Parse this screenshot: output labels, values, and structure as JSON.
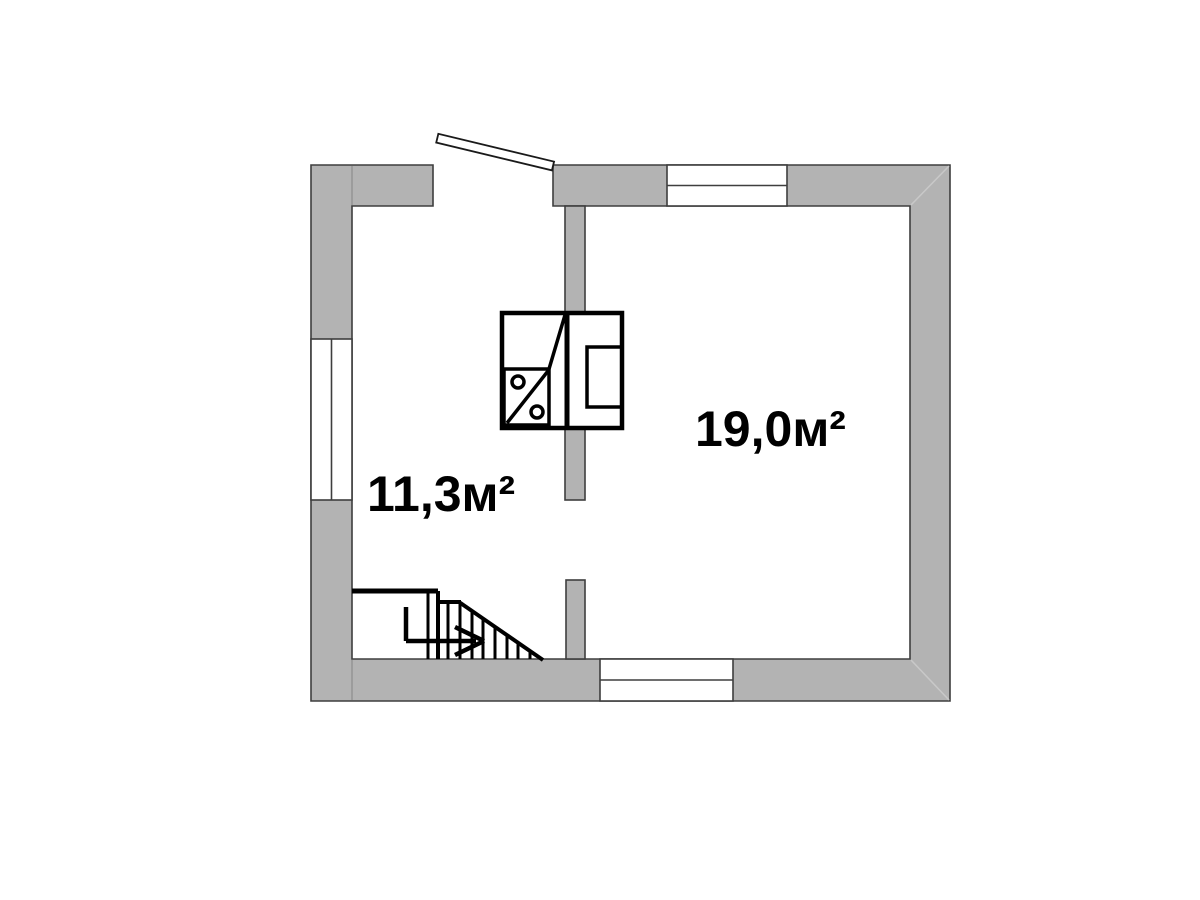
{
  "rooms": [
    {
      "id": "left-room",
      "area_label": "11,3м²"
    },
    {
      "id": "right-room",
      "area_label": "19,0м²"
    }
  ],
  "colors": {
    "background": "#ffffff",
    "wall_fill": "#b3b3b3",
    "wall_outline": "#3e3e3e",
    "black_line": "#000000",
    "miter_line": "#c8c8c8",
    "joint_line": "#8f8f8f",
    "label_color": "#000000"
  },
  "symbols": {
    "door": "open-door-leaf",
    "windows": [
      "left-wall-window",
      "top-wall-window",
      "bottom-wall-window"
    ],
    "staircase": "staircase-with-direction-arrow",
    "kitchen_unit": "sink-and-stove-block"
  }
}
